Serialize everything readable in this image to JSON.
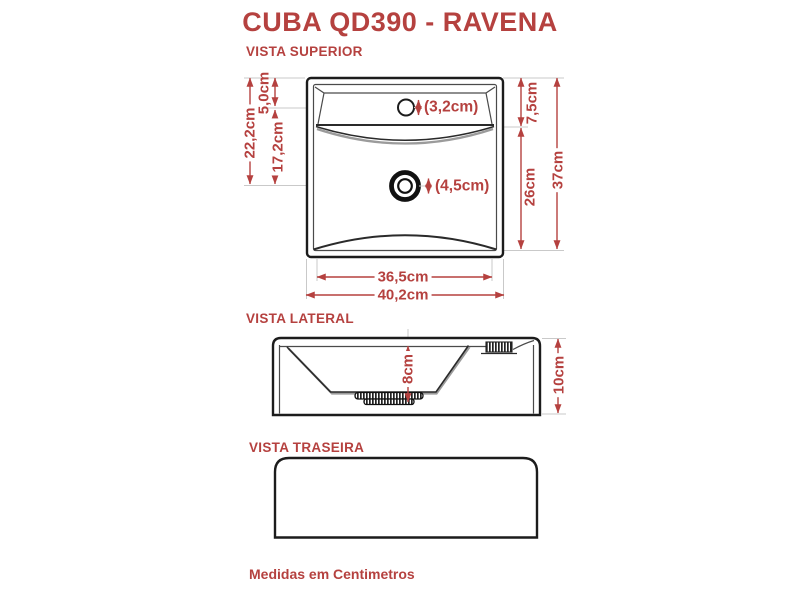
{
  "title": "CUBA QD390 - RAVENA",
  "footer_note": "Medidas em Centimetros",
  "colors": {
    "accent_red": "#b5413f",
    "line_dark": "#1c1c1c"
  },
  "views": {
    "superior": {
      "label": "VISTA SUPERIOR",
      "dimensions": {
        "rim_to_drain": "22,2cm",
        "top_to_faucet_line": "5,0cm",
        "faucet_line_to_drain": "17,2cm",
        "deck_depth": "7,5cm",
        "deck_to_bottom": "26cm",
        "overall_height": "37cm",
        "inner_width": "36,5cm",
        "overall_width": "40,2cm",
        "faucet_hole_diameter": "(3,2cm)",
        "drain_hole_diameter": "(4,5cm)"
      }
    },
    "lateral": {
      "label": "VISTA LATERAL",
      "dimensions": {
        "basin_depth": "8cm",
        "overall_height": "10cm"
      }
    },
    "traseira": {
      "label": "VISTA TRASEIRA"
    }
  }
}
